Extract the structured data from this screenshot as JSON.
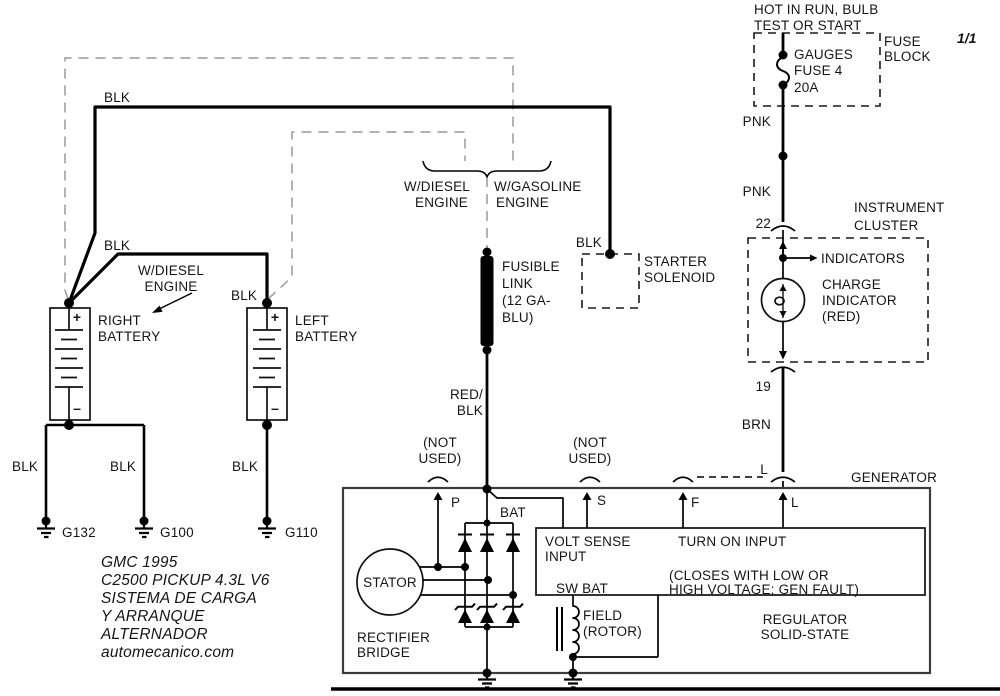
{
  "page": {
    "indicator": "1/1"
  },
  "fuse_block": {
    "header_line1": "HOT IN RUN, BULB",
    "header_line2": "TEST OR START",
    "box_label_line1": "FUSE",
    "box_label_line2": "BLOCK",
    "fuse_line1": "GAUGES",
    "fuse_line2": "FUSE 4",
    "fuse_line3": "20A"
  },
  "wire_labels": {
    "blk": "BLK",
    "pnk": "PNK",
    "brn": "BRN",
    "red_blk_line1": "RED/",
    "red_blk_line2": "BLK",
    "l": "L",
    "pin22": "22",
    "pin19": "19"
  },
  "instrument_cluster": {
    "title_line1": "INSTRUMENT",
    "title_line2": "CLUSTER",
    "indicators": "INDICATORS",
    "charge_line1": "CHARGE",
    "charge_line2": "INDICATOR",
    "charge_line3": "(RED)"
  },
  "engine_options": {
    "diesel_line1": "W/DIESEL",
    "diesel_line2": "ENGINE",
    "gasoline_line1": "W/GASOLINE",
    "gasoline_line2": "ENGINE"
  },
  "fusible_link": {
    "line1": "FUSIBLE",
    "line2": "LINK",
    "line3": "(12 GA-",
    "line4": "BLU)"
  },
  "starter_solenoid": {
    "line1": "STARTER",
    "line2": "SOLENOID"
  },
  "batteries": {
    "right_line1": "RIGHT",
    "right_line2": "BATTERY",
    "left_line1": "LEFT",
    "left_line2": "BATTERY",
    "note_line1": "W/DIESEL",
    "note_line2": "ENGINE",
    "plus": "+",
    "minus": "–"
  },
  "grounds": {
    "g132": "G132",
    "g100": "G100",
    "g110": "G110"
  },
  "generator": {
    "title": "GENERATOR",
    "terminal_p": "P",
    "terminal_s": "S",
    "terminal_f": "F",
    "terminal_l": "L",
    "bat": "BAT",
    "not_used_line1": "(NOT",
    "not_used_line2": "USED)",
    "volt_sense_line1": "VOLT SENSE",
    "volt_sense_line2": "INPUT",
    "sw_bat": "SW BAT",
    "turn_on_input": "TURN ON INPUT",
    "closes_line1": "(CLOSES WITH LOW OR",
    "closes_line2": "HIGH VOLTAGE; GEN FAULT)",
    "regulator_line1": "REGULATOR",
    "regulator_line2": "SOLID-STATE",
    "field_line1": "FIELD",
    "field_line2": "(ROTOR)",
    "stator": "STATOR",
    "rectifier_line1": "RECTIFIER",
    "rectifier_line2": "BRIDGE"
  },
  "footer": {
    "line1": "GMC  1995",
    "line2": "C2500 PICKUP 4.3L V6",
    "line3": "SISTEMA DE CARGA",
    "line4": "Y ARRANQUE",
    "line5": "ALTERNADOR",
    "line6": "automecanico.com"
  },
  "colors": {
    "wire": "#000000",
    "option_dashed": "#a6a6a6",
    "background": "#ffffff"
  }
}
